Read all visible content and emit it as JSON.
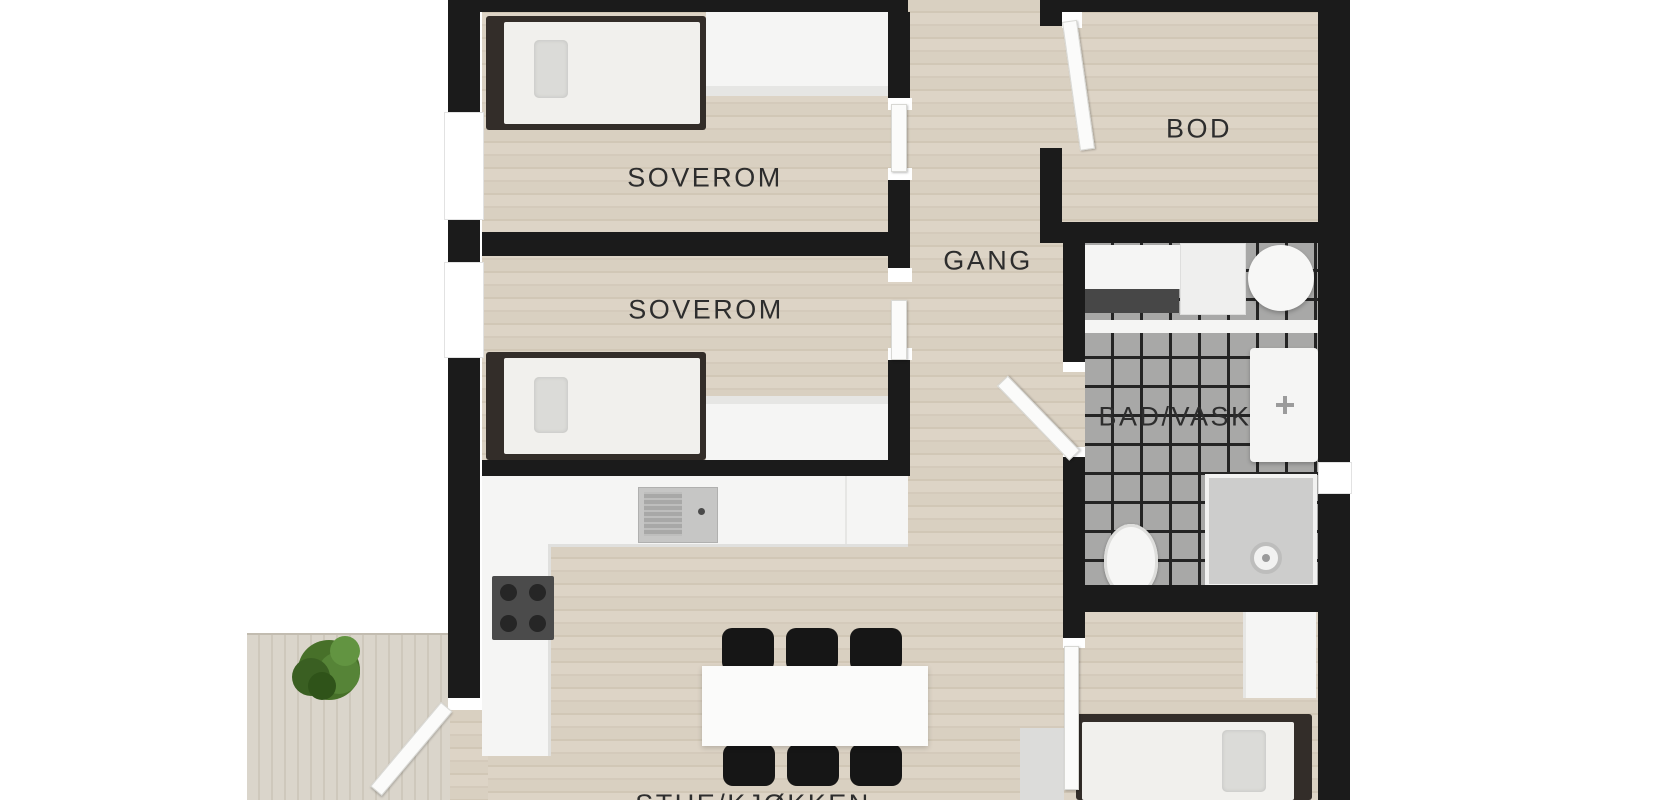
{
  "plan": {
    "type": "floor-plan",
    "rooms": [
      {
        "id": "soverom-1",
        "label": "SOVEROM"
      },
      {
        "id": "soverom-2",
        "label": "SOVEROM"
      },
      {
        "id": "gang",
        "label": "GANG"
      },
      {
        "id": "bod",
        "label": "BOD"
      },
      {
        "id": "bad-vask",
        "label": "BAD/VASK"
      },
      {
        "id": "stue-kjokken",
        "label": "STUE/KJØKKEN"
      }
    ],
    "furniture_icons": [
      "single-bed",
      "single-bed",
      "single-bed",
      "wardrobe",
      "sideboard",
      "kitchen-counter",
      "kitchen-sink",
      "stove",
      "dining-table",
      "dining-chair",
      "washing-machine",
      "round-basin",
      "vanity-sink",
      "toilet",
      "shower",
      "wardrobe",
      "dresser",
      "plant",
      "terrace-deck"
    ],
    "colors": {
      "background": "#ffffff",
      "wall": "#1b1b1b",
      "wood_floor": "#d8cfc0",
      "terrace_deck": "#d6d1c6",
      "bathroom_tile": "#a8a8a7",
      "tile_grid": "#242424",
      "furniture_white": "#f5f5f4",
      "bed_frame": "#332d29",
      "chair": "#161616",
      "plant": "#4c7a31",
      "label_text": "#2d2d2d"
    }
  }
}
